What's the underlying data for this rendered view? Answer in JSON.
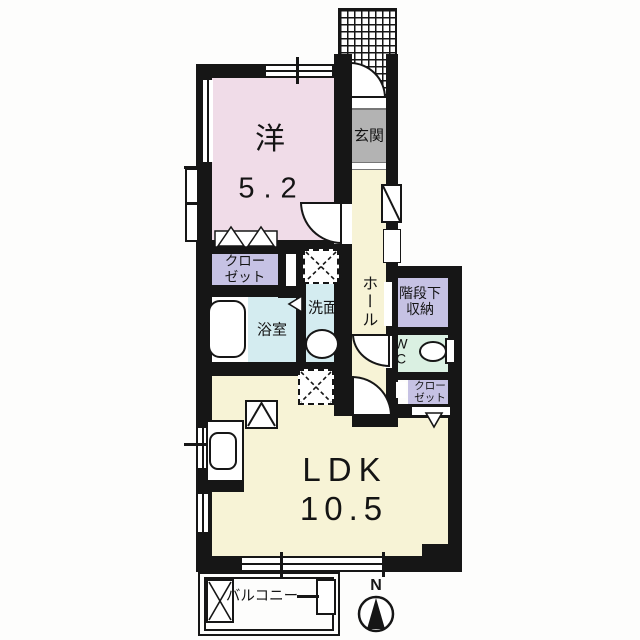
{
  "plan": {
    "rooms": {
      "western": {
        "name": "洋",
        "area": "5.2"
      },
      "entrance": {
        "name": "玄関"
      },
      "hall": {
        "name": "ホール"
      },
      "closet_upper": {
        "line1": "クロー",
        "line2": "ゼット"
      },
      "bath": {
        "name": "浴室"
      },
      "washroom": {
        "name": "洗面"
      },
      "stair_storage": {
        "line1": "階段下",
        "line2": "収納"
      },
      "wc": {
        "line1": "W",
        "line2": "C"
      },
      "closet_lower": {
        "line1": "クロー",
        "line2": "ゼット"
      },
      "ldk": {
        "name": "LDK",
        "area": "10.5"
      },
      "balcony": {
        "name": "バルコニー"
      }
    },
    "compass": {
      "north": "N"
    },
    "colors": {
      "wall": "#161616",
      "western_room": "#f0dce8",
      "ldk_hall": "#f7f3d6",
      "closet": "#c6c2e4",
      "bath_washroom": "#d4ecf0",
      "wc": "#daf0e2",
      "entrance": "#b3b3b3"
    }
  }
}
